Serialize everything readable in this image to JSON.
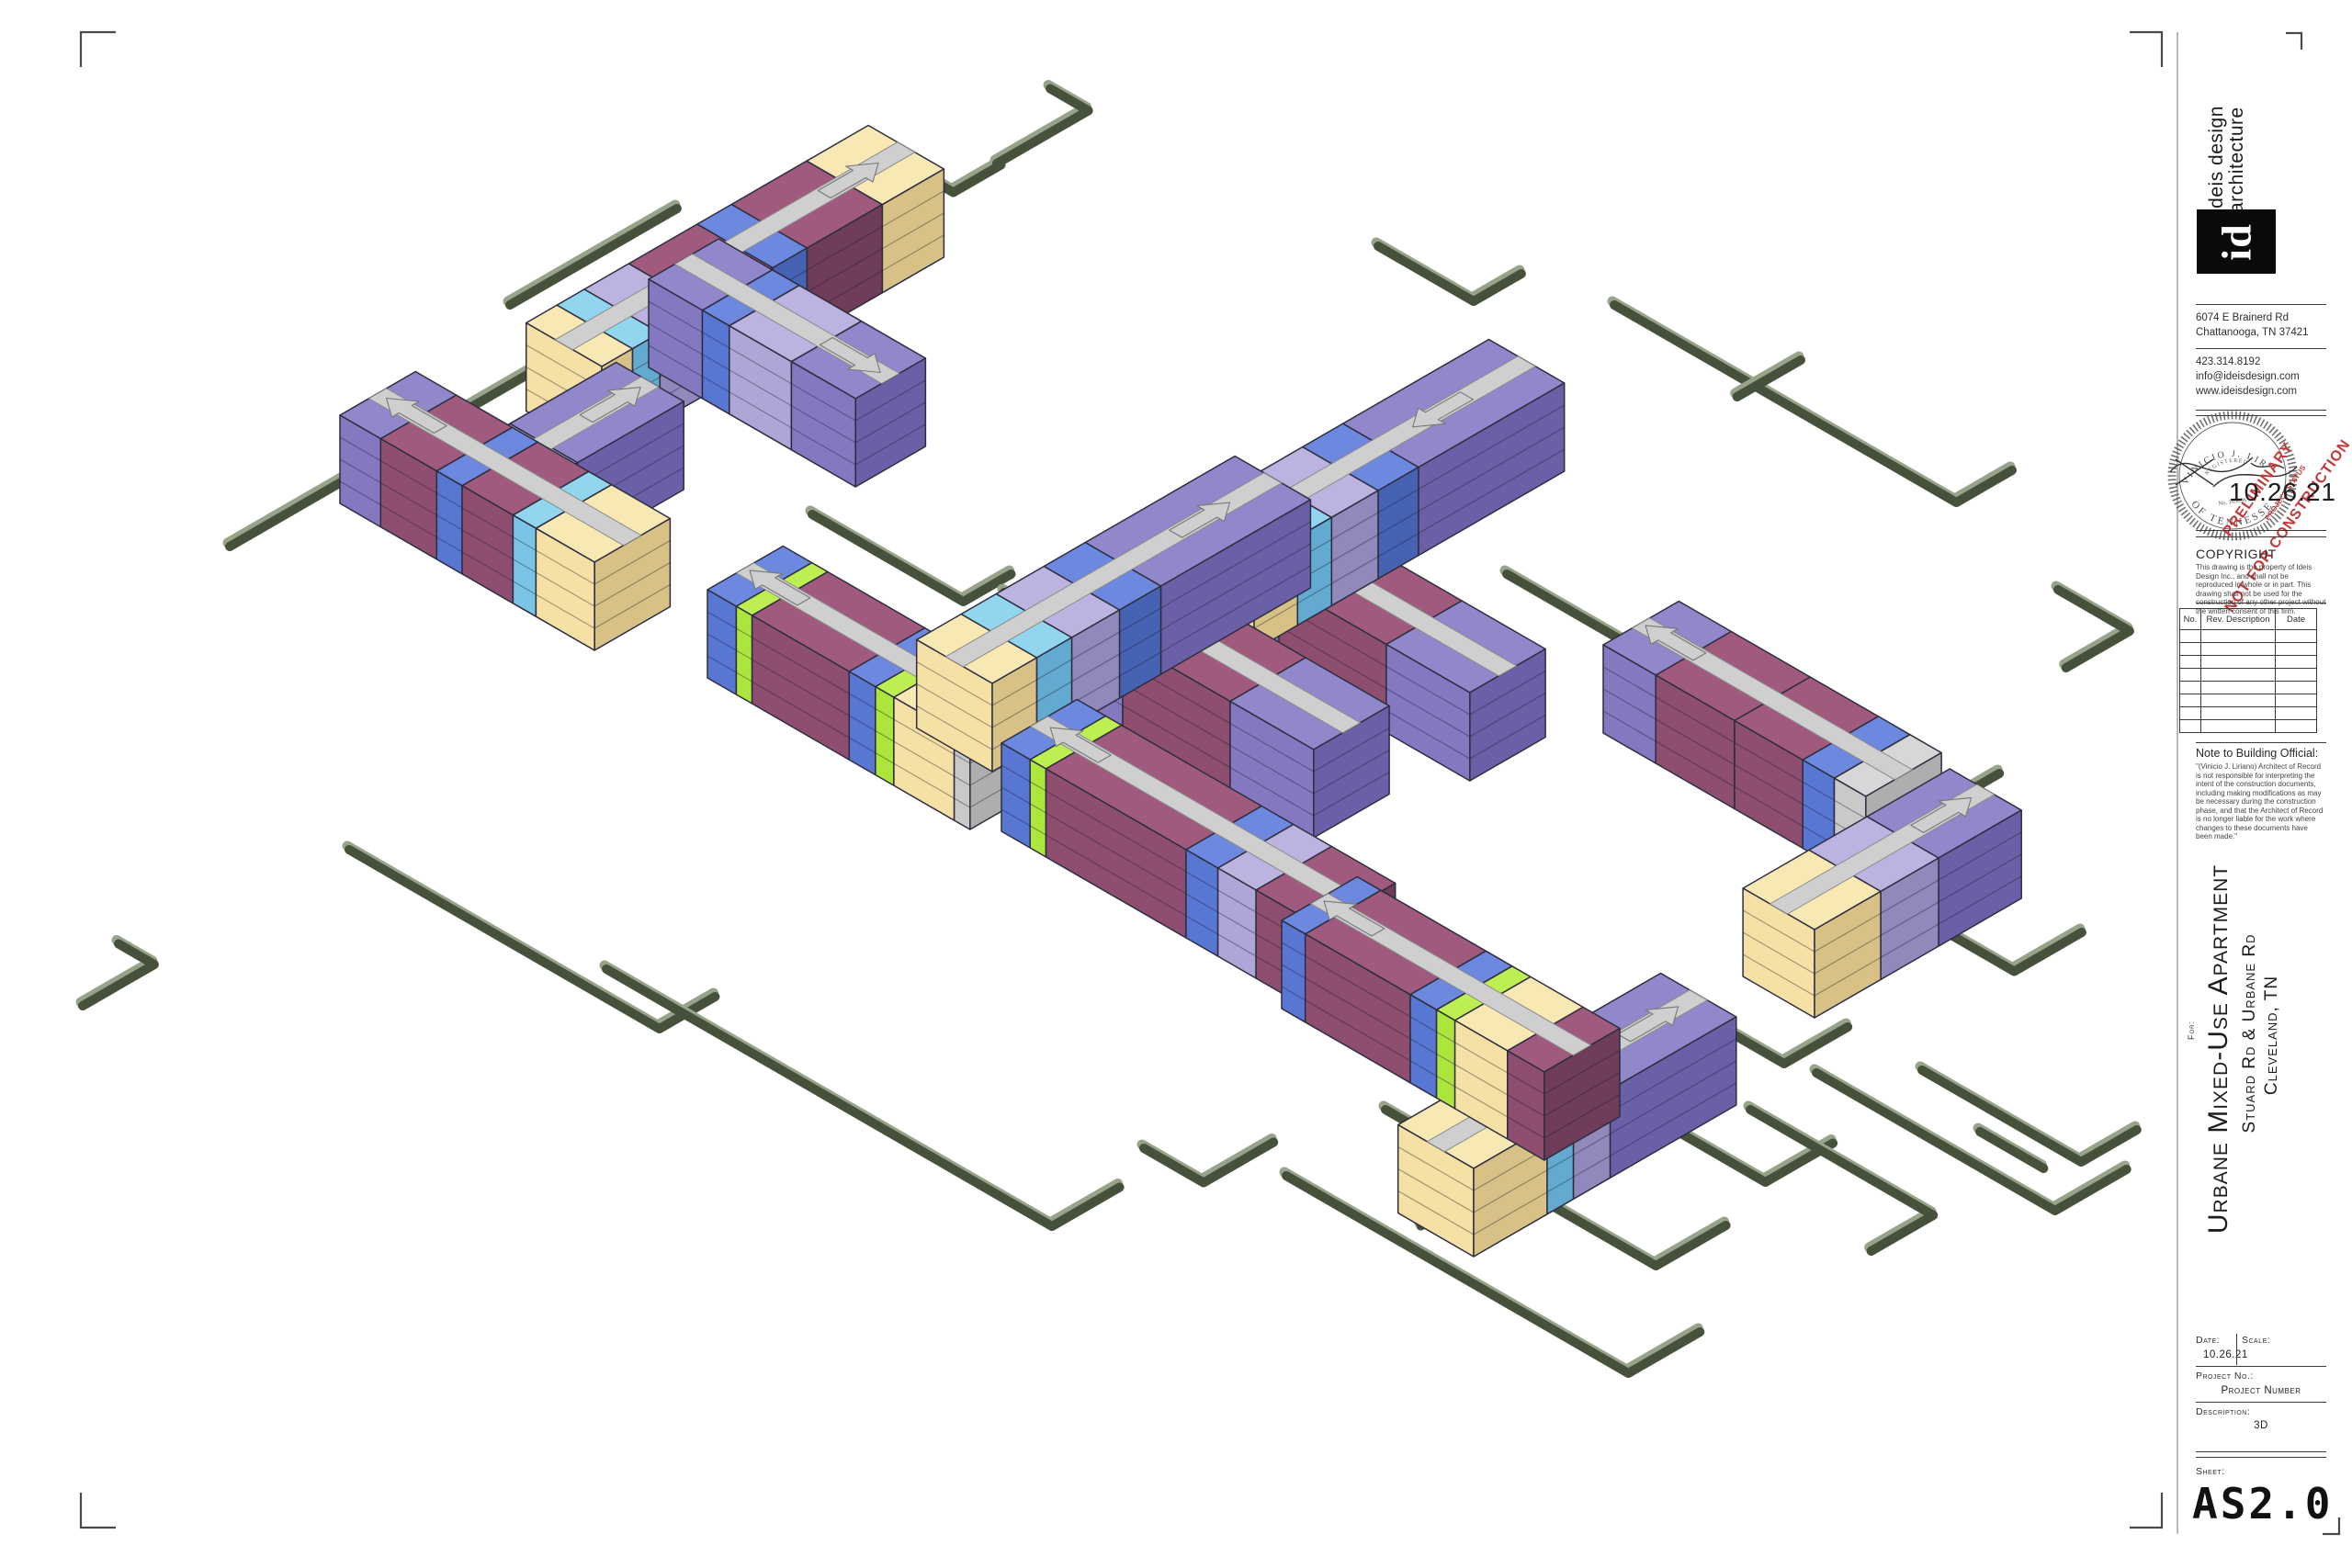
{
  "title_block": {
    "firm": {
      "name_line1": "ideis design",
      "name_line2": "architecture",
      "logo_text": "id",
      "address_line1": "6074 E Brainerd Rd",
      "address_line2": "Chattanooga, TN 37421",
      "phone": "423.314.8192",
      "email": "info@ideisdesign.com",
      "website": "www.ideisdesign.com"
    },
    "stamp": {
      "seal_arc_top": "VINICIO J. LIR",
      "seal_registered": "REGISTERED",
      "seal_arc_bottom": "OF TENNESSE",
      "seal_number": "No. 103696",
      "preliminary_line1": "PRELIMINARY",
      "preliminary_line2": "NOT FOR CONSTRUCTION",
      "project_status": "PROJECT STATUS",
      "date": "10.26.21"
    },
    "copyright": {
      "heading": "COPYRIGHT",
      "body": "This drawing is the property of Ideis Design Inc., and shall not be reproduced in whole or in part. This drawing shall not be used for the construction of any other project without the written consent of this firm."
    },
    "revisions": {
      "headers": [
        "No.",
        "Rev. Description",
        "Date"
      ],
      "empty_rows": 8
    },
    "note_to_building_official": {
      "heading": "Note to Building Official:",
      "body": "\"(Vinicio J. Liriano) Architect of Record is not responsible for interpreting the intent of the construction documents, including making modifications as may be necessary during the construction phase, and that the Architect of Record is no longer liable for the work where changes to these documents have been made.\""
    },
    "project": {
      "for_label": "For:",
      "title": "Urbane Mixed-Use Apartment",
      "address": "Stuard Rd & Urbane Rd",
      "city": "Cleveland, TN"
    },
    "info": {
      "date_label": "Date:",
      "date": "10.26.21",
      "scale_label": "Scale:",
      "scale": "",
      "project_no_label": "Project No.:",
      "project_no": "Project Number",
      "description_label": "Description:",
      "description": "3D",
      "sheet_label": "Sheet:",
      "sheet": "AS2.0"
    }
  },
  "drawing": {
    "palette": {
      "outline": "#2d2d3f",
      "corridor": "#cfcfcf",
      "corridor_stroke": "#8a8a8a",
      "curb": "#46513c",
      "curb_light": "#97a489",
      "colors": {
        "maroon": {
          "top": "#a05a7e",
          "sw": "#8e4e70",
          "se": "#6f3c59"
        },
        "purple": {
          "top": "#9187cb",
          "sw": "#8478c1",
          "se": "#6b60a7"
        },
        "lavender": {
          "top": "#bcb3e0",
          "sw": "#afa5d6",
          "se": "#9188bb"
        },
        "blue": {
          "top": "#6c89df",
          "sw": "#5877d3",
          "se": "#4662b3"
        },
        "cyan": {
          "top": "#92d5ee",
          "sw": "#7ac5e5",
          "se": "#62aacf"
        },
        "yellow": {
          "top": "#f8e9b4",
          "sw": "#f5e1a5",
          "se": "#d8c186"
        },
        "lime": {
          "top": "#bdee52",
          "sw": "#ace63d",
          "se": "#92cc2f"
        },
        "gray": {
          "top": "#d7d7d7",
          "sw": "#c9c9c9",
          "se": "#aeaeae"
        }
      }
    },
    "buildings": [
      {
        "id": "bldg-a-main",
        "axis": "u",
        "s": [
          655,
          495
        ],
        "len": 430,
        "depth": 95,
        "h": 96,
        "segments": [
          [
            "yellow",
            0.09
          ],
          [
            "cyan",
            0.08
          ],
          [
            "lavender",
            0.13
          ],
          [
            "maroon",
            0.2
          ],
          [
            "blue",
            0.1
          ],
          [
            "maroon",
            0.22
          ],
          [
            "yellow",
            0.18
          ]
        ],
        "corridor": true,
        "arrow": {
          "t": 0.84,
          "dir": 1
        }
      },
      {
        "id": "bldg-a-wing",
        "axis": "v",
        "s": [
          706,
          400
        ],
        "len": 260,
        "depth": 88,
        "h": 96,
        "segments": [
          [
            "purple",
            0.26
          ],
          [
            "blue",
            0.13
          ],
          [
            "lavender",
            0.3
          ],
          [
            "purple",
            0.31
          ]
        ],
        "corridor": true,
        "arrow": {
          "t": 0.82,
          "dir": 1
        }
      },
      {
        "id": "bldg-b-wing",
        "axis": "u",
        "s": [
          545,
          648
        ],
        "len": 230,
        "depth": 85,
        "h": 96,
        "segments": [
          [
            "lavender",
            0.42
          ],
          [
            "purple",
            0.58
          ]
        ],
        "corridor": true,
        "arrow": {
          "t": 0.8,
          "dir": 1
        }
      },
      {
        "id": "bldg-b-main",
        "axis": "v",
        "s": [
          370,
          548
        ],
        "len": 320,
        "depth": 95,
        "h": 96,
        "segments": [
          [
            "purple",
            0.16
          ],
          [
            "maroon",
            0.22
          ],
          [
            "blue",
            0.1
          ],
          [
            "maroon",
            0.2
          ],
          [
            "cyan",
            0.09
          ],
          [
            "yellow",
            0.23
          ]
        ],
        "corridor": true,
        "arrow": {
          "t": 0.14,
          "dir": -1
        }
      },
      {
        "id": "bldg-g-spine",
        "axis": "v",
        "s": [
          1340,
          700
        ],
        "len": 300,
        "depth": 95,
        "h": 96,
        "segments": [
          [
            "purple",
            0.2
          ],
          [
            "maroon",
            0.45
          ],
          [
            "purple",
            0.35
          ]
        ],
        "corridor": true,
        "arrow": {
          "t": 0.14,
          "dir": -1
        }
      },
      {
        "id": "bldg-g-bar",
        "axis": "u",
        "s": [
          1365,
          708
        ],
        "len": 390,
        "depth": 95,
        "h": 96,
        "segments": [
          [
            "yellow",
            0.14
          ],
          [
            "cyan",
            0.11
          ],
          [
            "lavender",
            0.15
          ],
          [
            "blue",
            0.13
          ],
          [
            "purple",
            0.47
          ]
        ],
        "corridor": true,
        "arrow": {
          "t": 0.72,
          "dir": -1
        }
      },
      {
        "id": "bldg-c",
        "axis": "v",
        "s": [
          770,
          738
        ],
        "len": 330,
        "depth": 95,
        "h": 96,
        "segments": [
          [
            "blue",
            0.11
          ],
          [
            "lime",
            0.06
          ],
          [
            "maroon",
            0.37
          ],
          [
            "blue",
            0.1
          ],
          [
            "lime",
            0.07
          ],
          [
            "yellow",
            0.23
          ],
          [
            "gray",
            0.06
          ]
        ],
        "corridor": true,
        "arrow": {
          "t": 0.12,
          "dir": -1
        }
      },
      {
        "id": "bldg-d-spine",
        "axis": "v",
        "s": [
          1170,
          762
        ],
        "len": 300,
        "depth": 95,
        "h": 96,
        "segments": [
          [
            "purple",
            0.2
          ],
          [
            "maroon",
            0.45
          ],
          [
            "purple",
            0.35
          ]
        ],
        "corridor": true,
        "arrow": {
          "t": 0.14,
          "dir": -1
        }
      },
      {
        "id": "bldg-d-bar",
        "axis": "u",
        "s": [
          1080,
          840
        ],
        "len": 400,
        "depth": 95,
        "h": 96,
        "segments": [
          [
            "yellow",
            0.14
          ],
          [
            "cyan",
            0.11
          ],
          [
            "lavender",
            0.15
          ],
          [
            "blue",
            0.13
          ],
          [
            "purple",
            0.47
          ]
        ],
        "corridor": true,
        "arrow": {
          "t": 0.78,
          "dir": 1
        }
      },
      {
        "id": "bldg-f-spine",
        "axis": "v",
        "s": [
          1745,
          798
        ],
        "len": 330,
        "depth": 95,
        "h": 96,
        "segments": [
          [
            "purple",
            0.2
          ],
          [
            "maroon",
            0.3
          ],
          [
            "maroon",
            0.26
          ],
          [
            "blue",
            0.12
          ],
          [
            "gray",
            0.12
          ]
        ],
        "corridor": true,
        "arrow": {
          "t": 0.12,
          "dir": -1
        }
      },
      {
        "id": "bldg-f-bar",
        "axis": "u",
        "s": [
          1975,
          1108
        ],
        "len": 260,
        "depth": 90,
        "h": 96,
        "segments": [
          [
            "yellow",
            0.32
          ],
          [
            "lavender",
            0.28
          ],
          [
            "purple",
            0.4
          ]
        ],
        "corridor": true,
        "arrow": {
          "t": 0.8,
          "dir": 1
        }
      },
      {
        "id": "bldg-e-upper",
        "axis": "v",
        "s": [
          1090,
          905
        ],
        "len": 400,
        "depth": 95,
        "h": 96,
        "segments": [
          [
            "blue",
            0.09
          ],
          [
            "lime",
            0.05
          ],
          [
            "maroon",
            0.44
          ],
          [
            "blue",
            0.1
          ],
          [
            "lavender",
            0.12
          ],
          [
            "maroon",
            0.2
          ]
        ],
        "corridor": true,
        "arrow": {
          "t": 0.12,
          "dir": -1
        }
      },
      {
        "id": "bldg-e-bar",
        "axis": "u",
        "s": [
          1604,
          1368
        ],
        "len": 330,
        "depth": 95,
        "h": 96,
        "segments": [
          [
            "yellow",
            0.28
          ],
          [
            "cyan",
            0.1
          ],
          [
            "lavender",
            0.14
          ],
          [
            "purple",
            0.48
          ]
        ],
        "corridor": true,
        "arrow": {
          "t": 0.82,
          "dir": 1
        }
      },
      {
        "id": "bldg-e-lower",
        "axis": "v",
        "s": [
          1395,
          1098
        ],
        "len": 330,
        "depth": 95,
        "h": 96,
        "segments": [
          [
            "blue",
            0.09
          ],
          [
            "maroon",
            0.4
          ],
          [
            "blue",
            0.1
          ],
          [
            "lime",
            0.07
          ],
          [
            "yellow",
            0.2
          ],
          [
            "maroon",
            0.14
          ]
        ],
        "corridor": true,
        "arrow": {
          "t": 0.12,
          "dir": -1
        }
      }
    ],
    "curbs": [
      {
        "s": [
          250,
          595
        ],
        "segs": [
          [
            "u",
            620
          ],
          [
            "v",
            70
          ]
        ]
      },
      {
        "s": [
          497,
          508
        ],
        "segs": [
          [
            "v",
            55
          ],
          [
            "u",
            -55
          ]
        ]
      },
      {
        "s": [
          938,
          152
        ],
        "segs": [
          [
            "v",
            115
          ],
          [
            "u",
            60
          ]
        ]
      },
      {
        "s": [
          1085,
          178
        ],
        "segs": [
          [
            "u",
            115
          ],
          [
            "v",
            -48
          ]
        ]
      },
      {
        "s": [
          555,
          332
        ],
        "segs": [
          [
            "u",
            210
          ]
        ]
      },
      {
        "s": [
          90,
          1095
        ],
        "segs": [
          [
            "u",
            90
          ],
          [
            "v",
            -45
          ]
        ]
      },
      {
        "s": [
          380,
          925
        ],
        "segs": [
          [
            "v",
            390
          ],
          [
            "u",
            70
          ]
        ]
      },
      {
        "s": [
          660,
          1055
        ],
        "segs": [
          [
            "v",
            560
          ],
          [
            "u",
            85
          ]
        ]
      },
      {
        "s": [
          1245,
          1250
        ],
        "segs": [
          [
            "v",
            75
          ],
          [
            "u",
            88
          ]
        ]
      },
      {
        "s": [
          884,
          560
        ],
        "segs": [
          [
            "v",
            190
          ],
          [
            "u",
            60
          ]
        ]
      },
      {
        "s": [
          1093,
          645
        ],
        "segs": [
          [
            "v",
            110
          ],
          [
            "u",
            55
          ]
        ]
      },
      {
        "s": [
          1640,
          625
        ],
        "segs": [
          [
            "v",
            415
          ]
        ]
      },
      {
        "s": [
          1830,
          745
        ],
        "segs": [
          [
            "u",
            -80
          ]
        ]
      },
      {
        "s": [
          2055,
          852
        ],
        "segs": [
          [
            "v",
            60
          ],
          [
            "u",
            80
          ]
        ]
      },
      {
        "s": [
          1977,
          1168
        ],
        "segs": [
          [
            "v",
            300
          ],
          [
            "u",
            90
          ]
        ]
      },
      {
        "s": [
          2110,
          1010
        ],
        "segs": [
          [
            "v",
            95
          ],
          [
            "u",
            85
          ]
        ]
      },
      {
        "s": [
          1400,
          1280
        ],
        "segs": [
          [
            "v",
            430
          ],
          [
            "u",
            90
          ]
        ]
      },
      {
        "s": [
          1508,
          1208
        ],
        "segs": [
          [
            "v",
            340
          ],
          [
            "u",
            88
          ]
        ]
      },
      {
        "s": [
          1620,
          1292
        ],
        "segs": [
          [
            "u",
            -85
          ]
        ]
      },
      {
        "s": [
          1705,
          1162
        ],
        "segs": [
          [
            "v",
            250
          ],
          [
            "u",
            85
          ]
        ]
      },
      {
        "s": [
          1905,
          1208
        ],
        "segs": [
          [
            "v",
            230
          ],
          [
            "u",
            -78
          ]
        ]
      },
      {
        "s": [
          2092,
          1165
        ],
        "segs": [
          [
            "v",
            200
          ],
          [
            "u",
            70
          ]
        ]
      },
      {
        "s": [
          1838,
          1098
        ],
        "segs": [
          [
            "v",
            120
          ],
          [
            "u",
            80
          ]
        ]
      },
      {
        "s": [
          1757,
          332
        ],
        "segs": [
          [
            "v",
            430
          ],
          [
            "u",
            70
          ]
        ]
      },
      {
        "s": [
          1960,
          392
        ],
        "segs": [
          [
            "u",
            -80
          ]
        ]
      },
      {
        "s": [
          2240,
          642
        ],
        "segs": [
          [
            "v",
            90
          ],
          [
            "u",
            -80
          ]
        ]
      },
      {
        "s": [
          1500,
          268
        ],
        "segs": [
          [
            "v",
            120
          ],
          [
            "u",
            60
          ]
        ]
      },
      {
        "s": [
          2155,
          1232
        ],
        "segs": [
          [
            "v",
            80
          ]
        ]
      }
    ]
  }
}
